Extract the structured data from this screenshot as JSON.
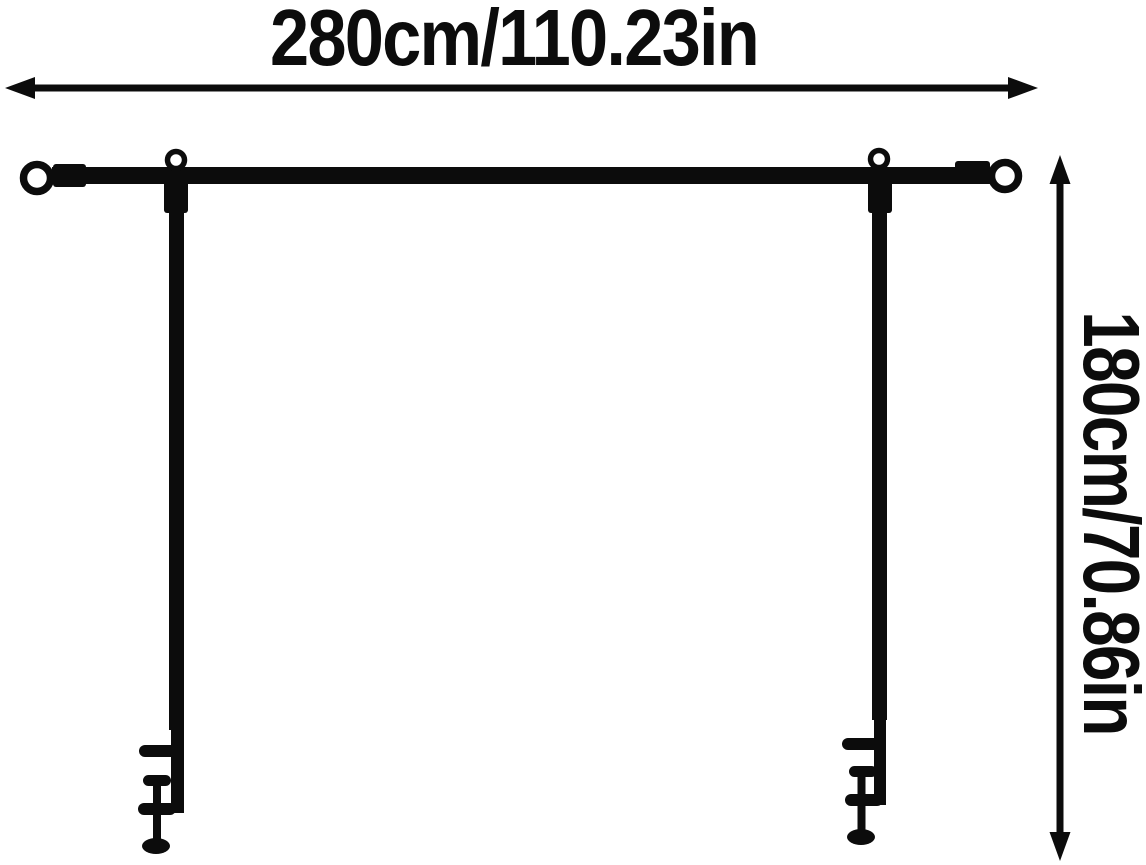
{
  "dimensions": {
    "width": {
      "label": "280cm/110.23in",
      "value_cm": 280,
      "value_in": 110.23
    },
    "height": {
      "label": "180cm/70.86in",
      "value_cm": 180,
      "value_in": 70.86
    }
  },
  "colors": {
    "ink": "#0c0c0c",
    "background": "#ffffff"
  },
  "icons": {
    "width_arrow": "double-headed-horizontal-arrow",
    "height_arrow": "double-headed-vertical-arrow",
    "end_rings": "open-ring-finial",
    "pole_rings": "hook-ring",
    "clamps": "c-clamp-table-mount"
  }
}
